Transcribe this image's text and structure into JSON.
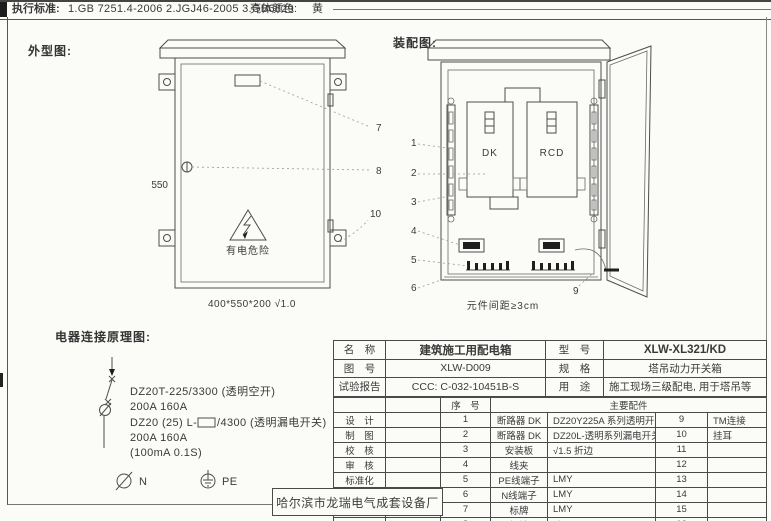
{
  "header": {
    "standards_label": "执行标准:",
    "standards": "1.GB 7251.4-2006    2.JGJ46-2005    3.GB6829",
    "shell_color_label": "壳体颜色:",
    "shell_color_value": "黄"
  },
  "outline": {
    "title": "外型图:",
    "height_dim": "550",
    "warning_text": "有电危险",
    "size_note": "400*550*200 √1.0",
    "callout_7": "7",
    "callout_8": "8",
    "callout_10": "10"
  },
  "assembly": {
    "title": "装配图:",
    "dk_label": "DK",
    "rcd_label": "RCD",
    "spacing_note": "元件间距≥3cm",
    "callout_1": "1",
    "callout_2": "2",
    "callout_3": "3",
    "callout_4": "4",
    "callout_5": "5",
    "callout_6": "6",
    "callout_9": "9"
  },
  "schematic": {
    "title": "电器连接原理图:",
    "line1": "DZ20T-225/3300 (透明空开)",
    "line2": "200A  160A",
    "line3a": "DZ20 (25) L-",
    "line3b": "/4300 (透明漏电开关)",
    "line4": "200A  160A",
    "line5": "(100mA 0.1S)",
    "n_label": "N",
    "pe_label": "PE"
  },
  "titleblock": {
    "info": {
      "name_label": "名　称",
      "name_value": "建筑施工用配电箱",
      "model_label": "型　号",
      "model_value": "XLW-XL321/KD",
      "drawing_label": "图　号",
      "drawing_value": "XLW-D009",
      "spec_label": "规　格",
      "spec_value": "塔吊动力开关箱",
      "report_label": "试验报告",
      "report_value": "CCC: C-032-10451B-S",
      "use_label": "用　途",
      "use_value": "施工现场三级配电, 用于塔吊等"
    },
    "header": {
      "seq": "序　号",
      "parts": "主要配件"
    },
    "rows": [
      {
        "left": "设　计",
        "no": "1",
        "part": "断路器 DK",
        "spec": "DZ20Y225A 系列透明开关",
        "no2": "9",
        "part2": "TM连接"
      },
      {
        "left": "制　图",
        "no": "2",
        "part": "断路器 DK",
        "spec": "DZ20L-透明系列漏电开关",
        "no2": "10",
        "part2": "挂耳"
      },
      {
        "left": "校　核",
        "no": "3",
        "part": "安装板",
        "spec": "√1.5 折边",
        "no2": "11",
        "part2": ""
      },
      {
        "left": "审　核",
        "no": "4",
        "part": "线夹",
        "spec": "",
        "no2": "12",
        "part2": ""
      },
      {
        "left": "标准化",
        "no": "5",
        "part": "PE线端子",
        "spec": "LMY",
        "no2": "13",
        "part2": ""
      },
      {
        "left": "日　期",
        "no": "6",
        "part": "N线端子",
        "spec": "LMY",
        "no2": "14",
        "part2": ""
      },
      {
        "left": "",
        "no": "7",
        "part": "标牌",
        "spec": "LMY",
        "no2": "15",
        "part2": ""
      },
      {
        "left": "",
        "no": "8",
        "part": "压把锁孔",
        "spec": "防雨",
        "no2": "16",
        "part2": ""
      }
    ],
    "factory": "哈尔滨市龙瑞电气成套设备厂"
  }
}
